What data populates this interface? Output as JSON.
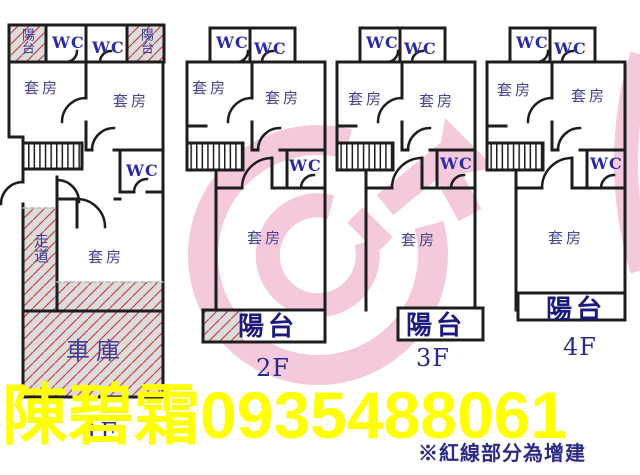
{
  "document": {
    "kind": "real-estate floor plan sheet",
    "floor_count": 4
  },
  "floors": [
    {
      "id": "1F",
      "floor_label": "1F",
      "rooms": {
        "balcony_top_left": "陽台",
        "wc_top_1": "WC",
        "wc_top_2": "WC",
        "balcony_top_right": "陽台",
        "suite_upper_left": "套房",
        "suite_upper_right": "套房",
        "wc_mid": "WC",
        "corridor": "走道",
        "suite_center": "套房",
        "garage": "車庫"
      }
    },
    {
      "id": "2F",
      "floor_label": "2F",
      "rooms": {
        "wc_top_1": "WC",
        "wc_top_2": "WC",
        "suite_upper_left": "套房",
        "suite_upper_right": "套房",
        "wc_mid": "WC",
        "suite_lower": "套房",
        "balcony": "陽台"
      }
    },
    {
      "id": "3F",
      "floor_label": "3F",
      "rooms": {
        "wc_top_1": "WC",
        "wc_top_2": "WC",
        "suite_upper_left": "套房",
        "suite_upper_right": "套房",
        "wc_mid": "WC",
        "suite_lower": "套房",
        "balcony": "陽台"
      }
    },
    {
      "id": "4F",
      "floor_label": "4F",
      "rooms": {
        "wc_top_1": "WC",
        "wc_top_2": "WC",
        "suite_upper_left": "套房",
        "suite_upper_right": "套房",
        "wc_mid": "WC",
        "suite_lower": "套房",
        "balcony": "陽台"
      }
    }
  ],
  "overlay": {
    "agent_name": "陳碧霜",
    "phone": "0935488061",
    "watermark_text": "陳碧霜0935488061"
  },
  "note": "※紅線部分為增建",
  "colors": {
    "wall": "#1d1d1d",
    "room_text": "#45458f",
    "wc_text": "#2b2ba6",
    "balcony_text": "#1b1b7e",
    "floor_text": "#2a2a8e",
    "overlay_yellow": "#ffff00",
    "note_navy": "#2b2b85",
    "hatch_bg": "#dcdcdc",
    "hatch_line": "#c64545",
    "watermark_pink": "#f4c9dc"
  }
}
